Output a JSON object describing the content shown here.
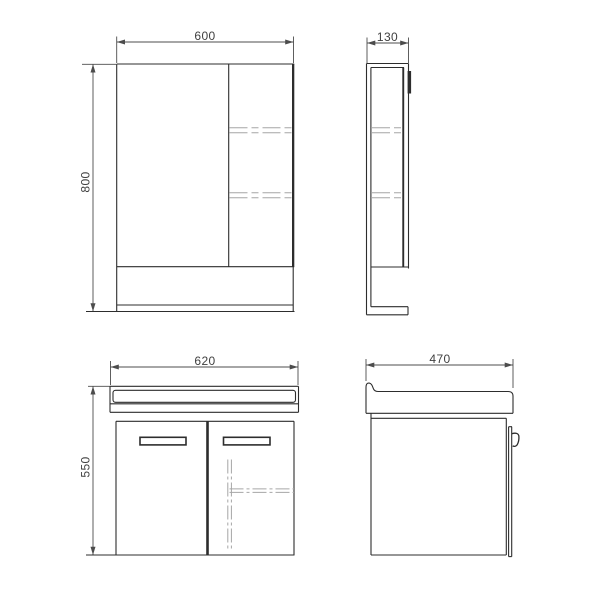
{
  "drawing": {
    "dimensions": {
      "mirror_front_width": "600",
      "mirror_front_height": "800",
      "mirror_side_depth": "130",
      "vanity_front_width": "620",
      "vanity_front_height": "550",
      "vanity_side_depth": "470"
    },
    "colors": {
      "object_line": "#2d2d2d",
      "dimension_line": "#4c4c4c",
      "hidden_line": "#a6a6a6",
      "text": "#3f3f3f",
      "background": "#ffffff"
    }
  }
}
